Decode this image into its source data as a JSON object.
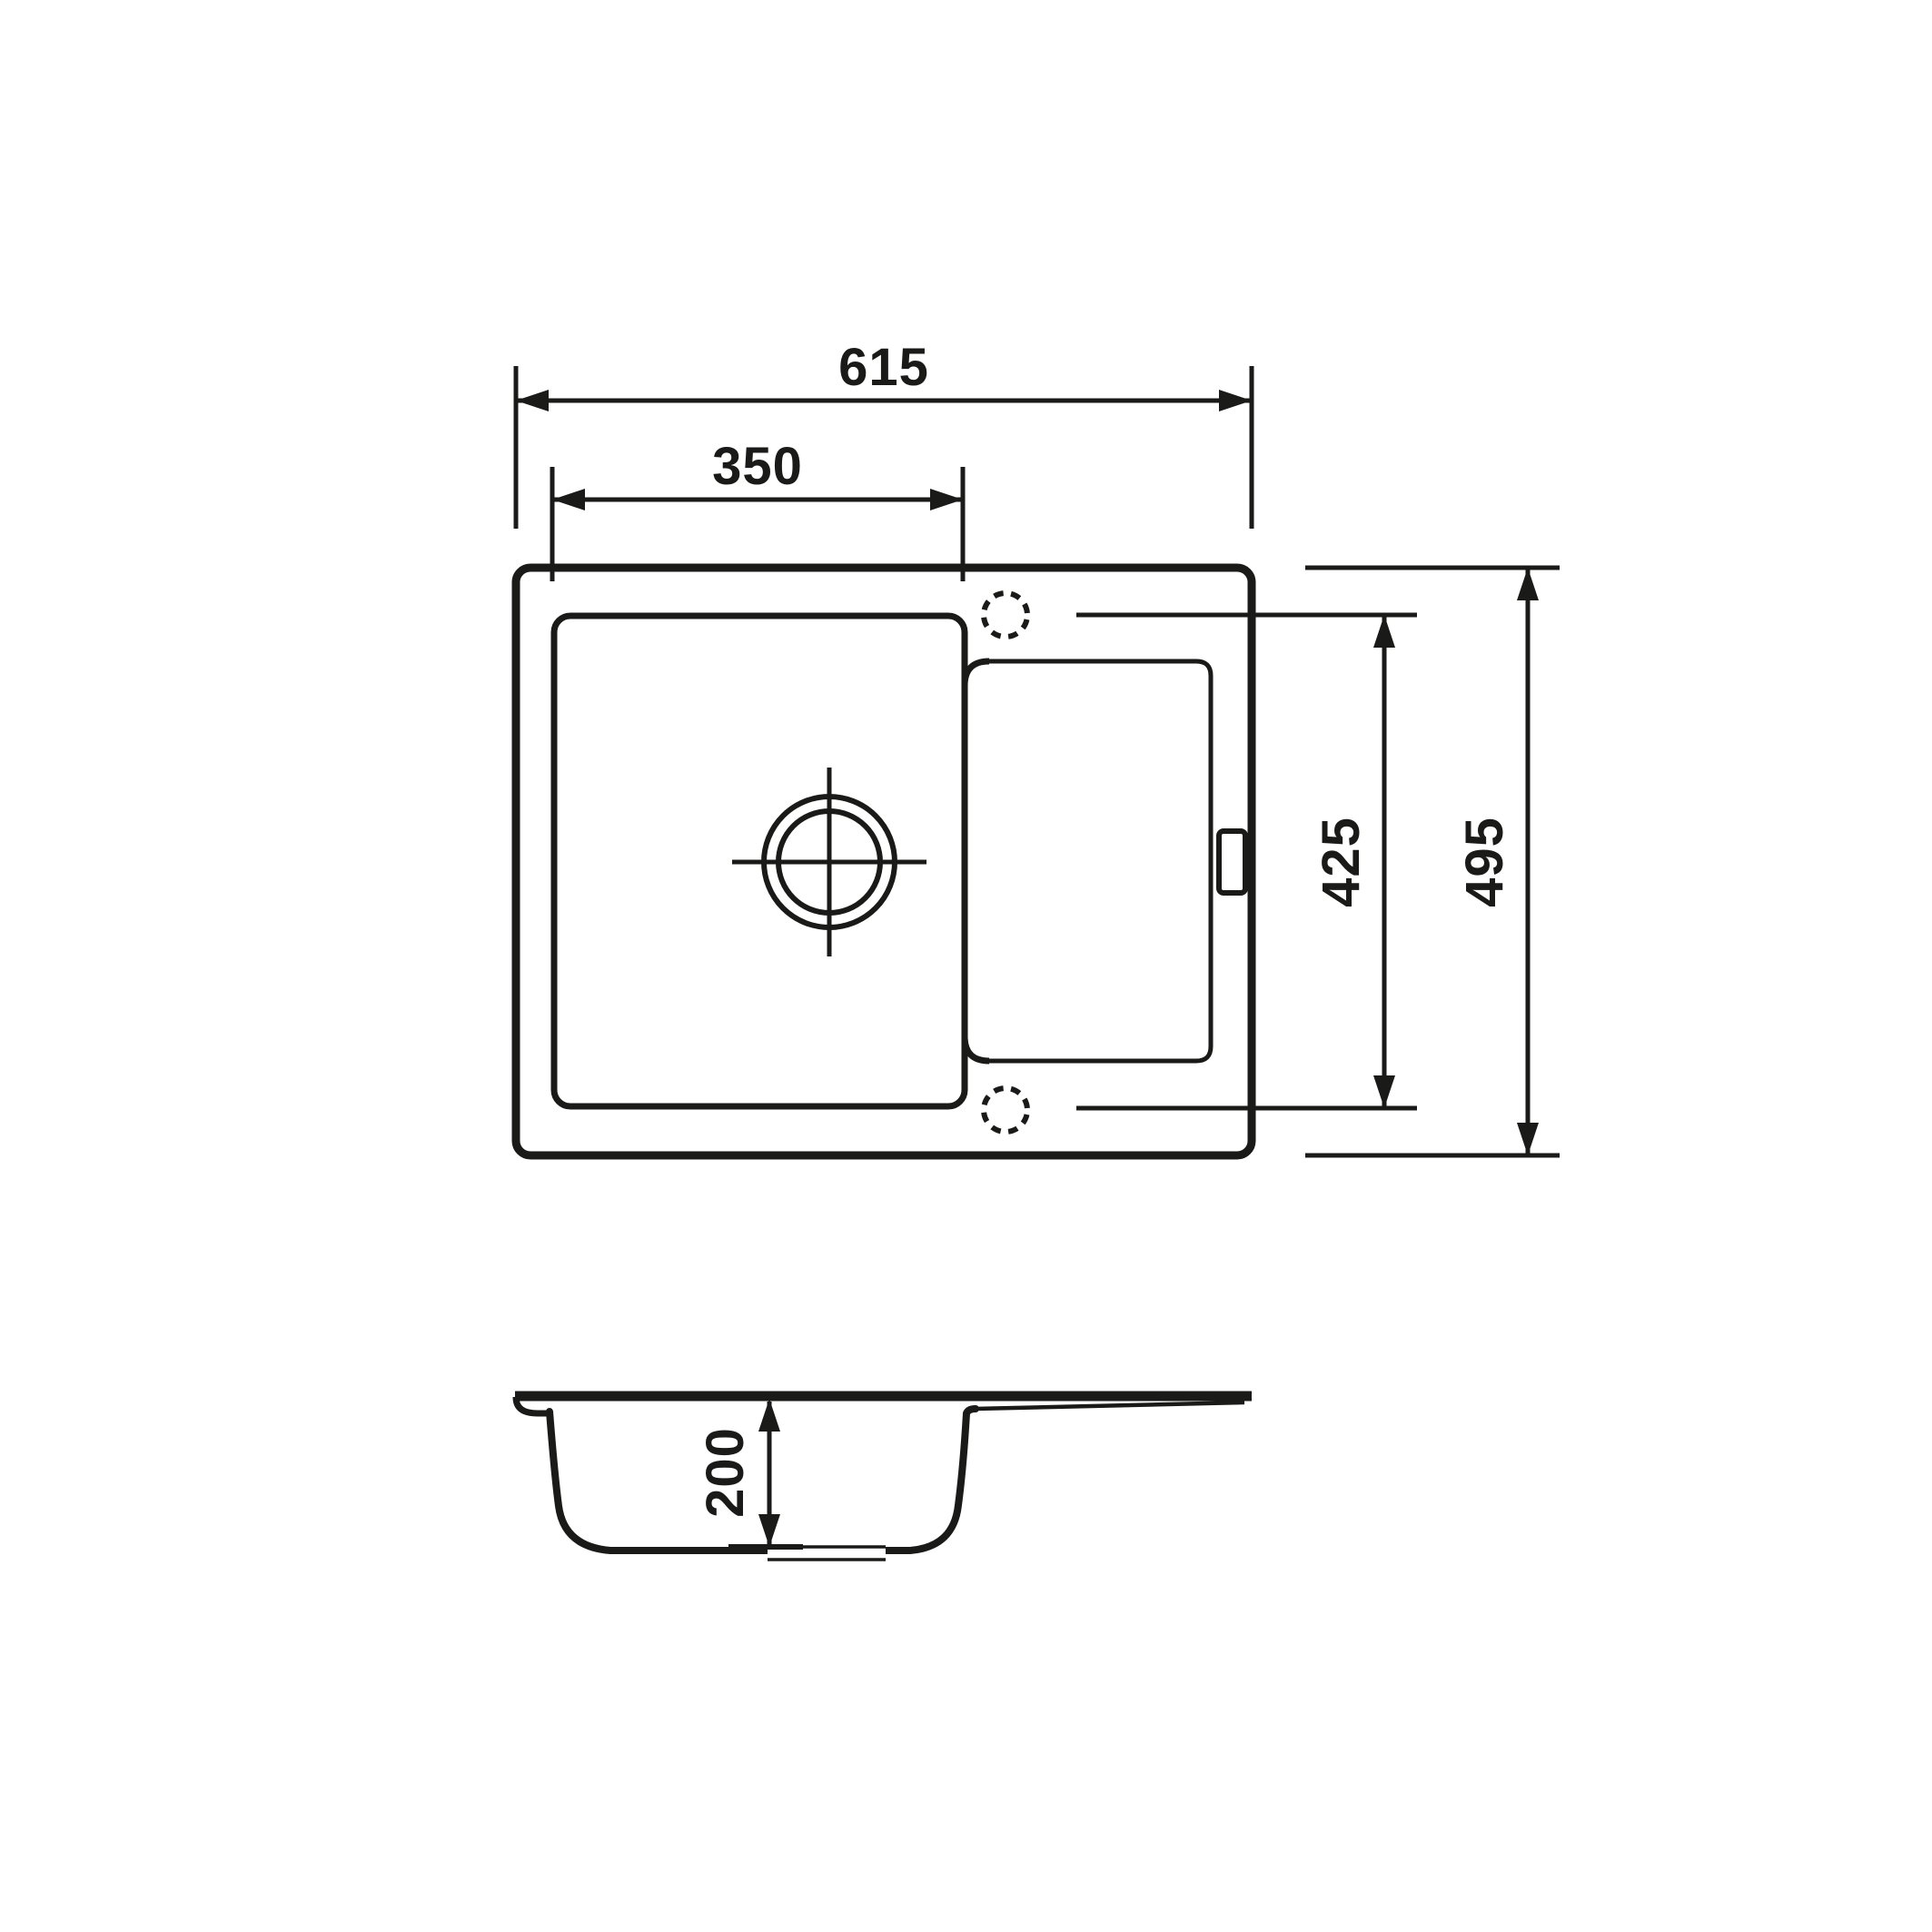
{
  "drawing": {
    "title": "sink-technical-drawing",
    "plan_view": {
      "overall_width_mm": "615",
      "bowl_width_mm": "350",
      "tap_hole_span_mm": "425",
      "overall_depth_mm": "495"
    },
    "section_view": {
      "bowl_depth_mm": "200"
    },
    "colors": {
      "line": "#1a1a18",
      "background": "#ffffff"
    }
  }
}
